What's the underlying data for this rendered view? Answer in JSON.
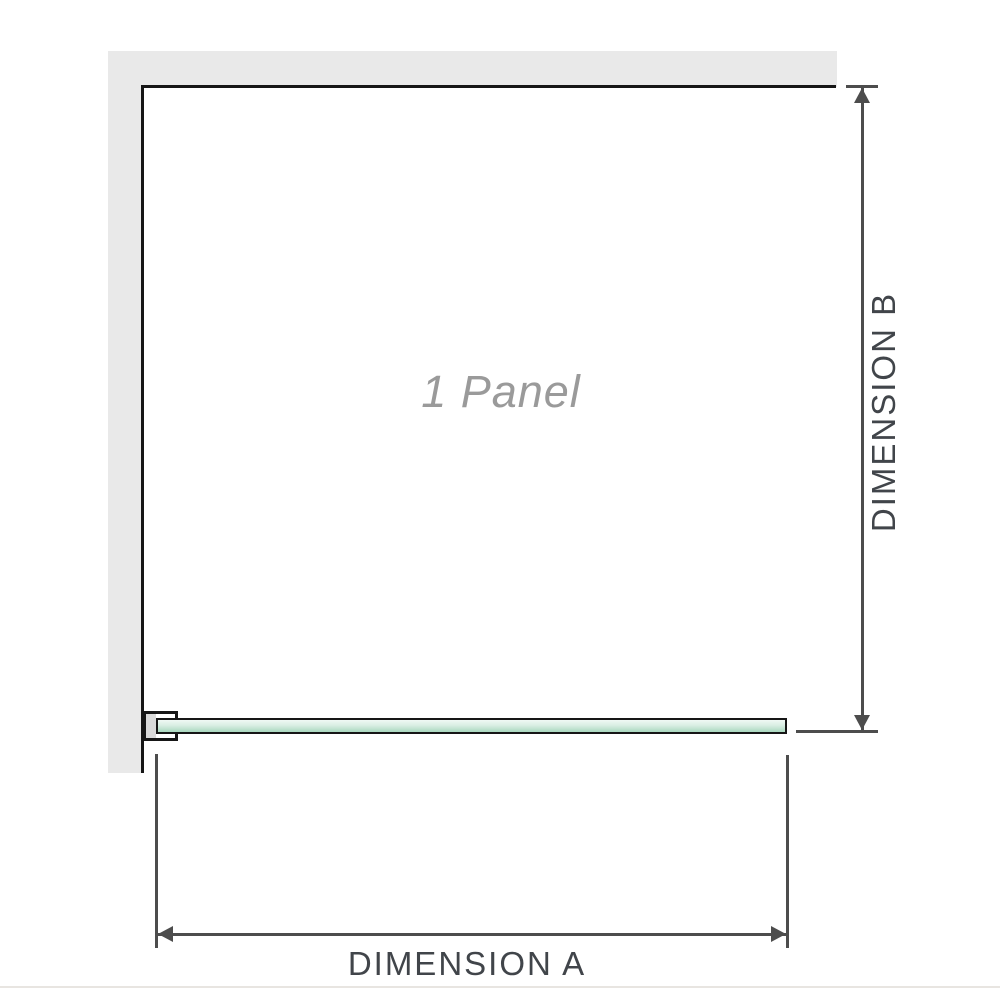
{
  "diagram": {
    "panel_label": "1 Panel",
    "dimension_a_label": "DIMENSION A",
    "dimension_b_label": "DIMENSION B"
  },
  "colors": {
    "background": "#ffffff",
    "wall_fill": "#e9e9e9",
    "wall_edge": "#161616",
    "dimension_line": "#4d4d4d",
    "dimension_text": "#41454a",
    "panel_text": "#9a9a9a",
    "glass_light": "#f0f9f4",
    "glass_dark": "#a9d8bf",
    "glass_border": "#161616",
    "bracket_fill": "#ffffff",
    "bracket_gray": "#d9d9d9",
    "baseline": "#e8e5e1"
  }
}
